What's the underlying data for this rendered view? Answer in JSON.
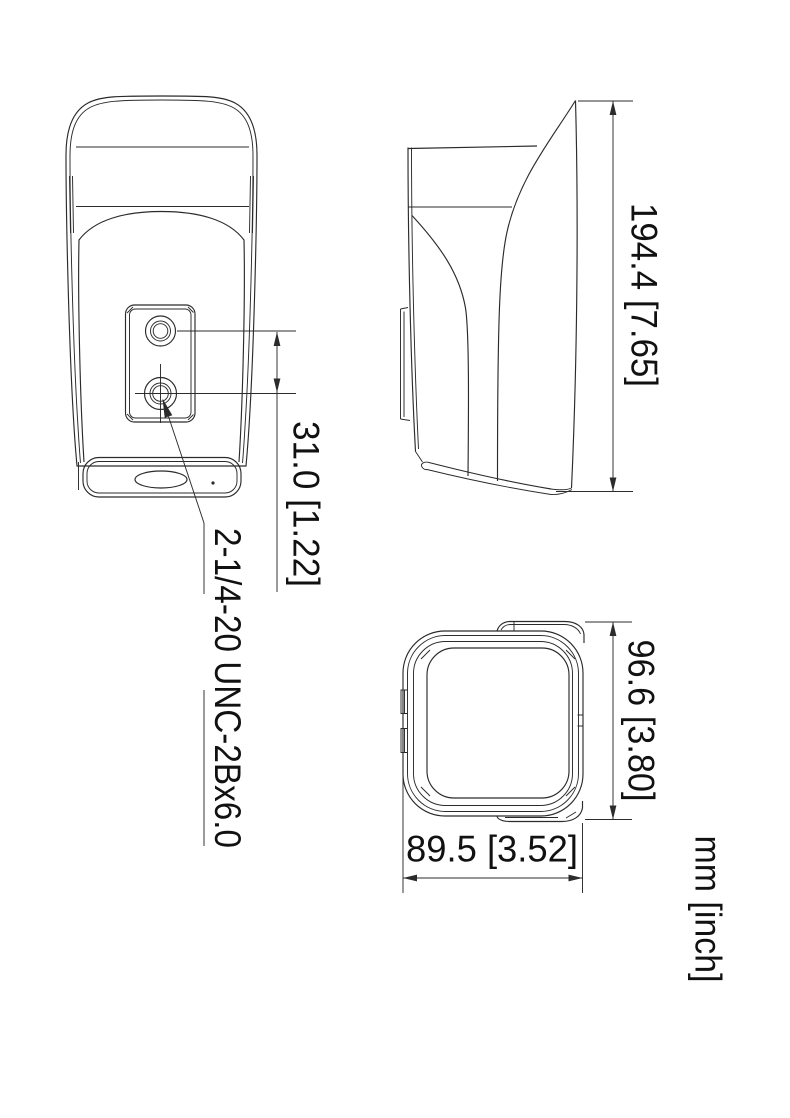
{
  "drawing": {
    "units_label": "mm [inch]",
    "thread_callout": "2-1/4-20 UNC-2Bx6.0",
    "dimensions": {
      "height": {
        "label": "194.4 [7.65]",
        "mm": 194.4,
        "inch": 7.65
      },
      "mount_hole_spacing": {
        "label": "31.0 [1.22]",
        "mm": 31.0,
        "inch": 1.22
      },
      "depth": {
        "label": "96.6 [3.80]",
        "mm": 96.6,
        "inch": 3.8
      },
      "width": {
        "label": "89.5 [3.52]",
        "mm": 89.5,
        "inch": 3.52
      }
    },
    "style": {
      "line_color": "#2b2b2b",
      "text_color": "#111111",
      "background": "#ffffff"
    }
  }
}
